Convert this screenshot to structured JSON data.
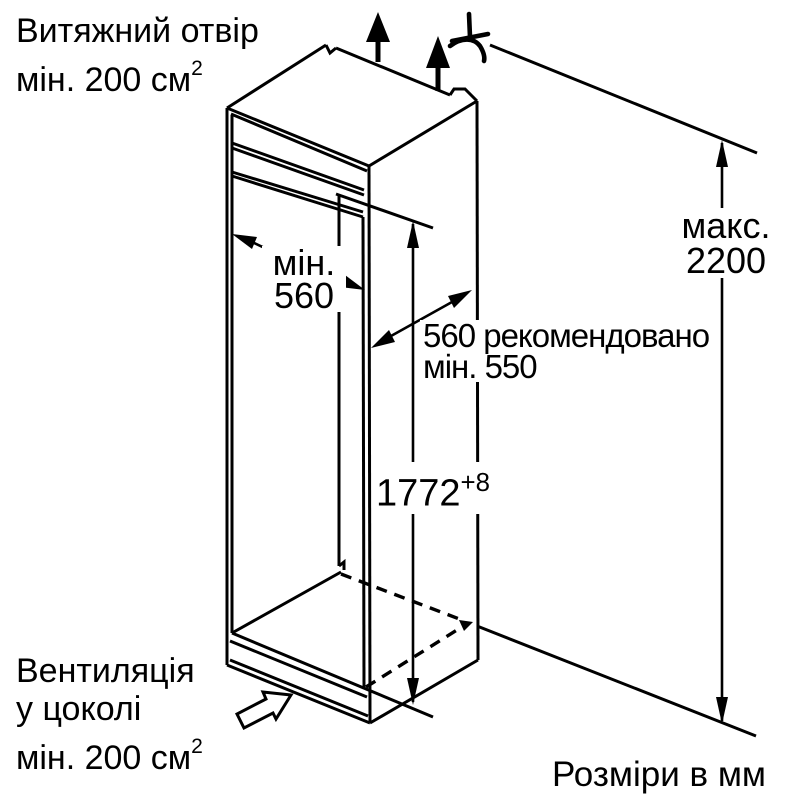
{
  "colors": {
    "ink": "#000000",
    "background": "#ffffff"
  },
  "annotations": {
    "exhaust_top": {
      "line1": "Витяжний отвір",
      "line2": "мін. 200 см",
      "line2_sup": "2"
    },
    "niche_width": {
      "line1": "мін.",
      "line2": "560"
    },
    "niche_depth": {
      "line1": "560 рекомендовано",
      "line2": "мін. 550"
    },
    "niche_height": {
      "value": "1772",
      "sup": "+8"
    },
    "max_height": {
      "line1": "макс.",
      "line2": "2200"
    },
    "plinth_vent": {
      "line1": "Вентиляція",
      "line2": "у цоколі",
      "line3": "мін. 200 см",
      "line3_sup": "2"
    },
    "units_note": "Розміри в мм"
  },
  "icons": {
    "airflow_up": "solid up arrow (exhaust air flow)",
    "no_kink": "crossed curved-hose symbol",
    "plinth_airflow": "hollow block arrow pointing up-right (plinth ventilation)"
  }
}
